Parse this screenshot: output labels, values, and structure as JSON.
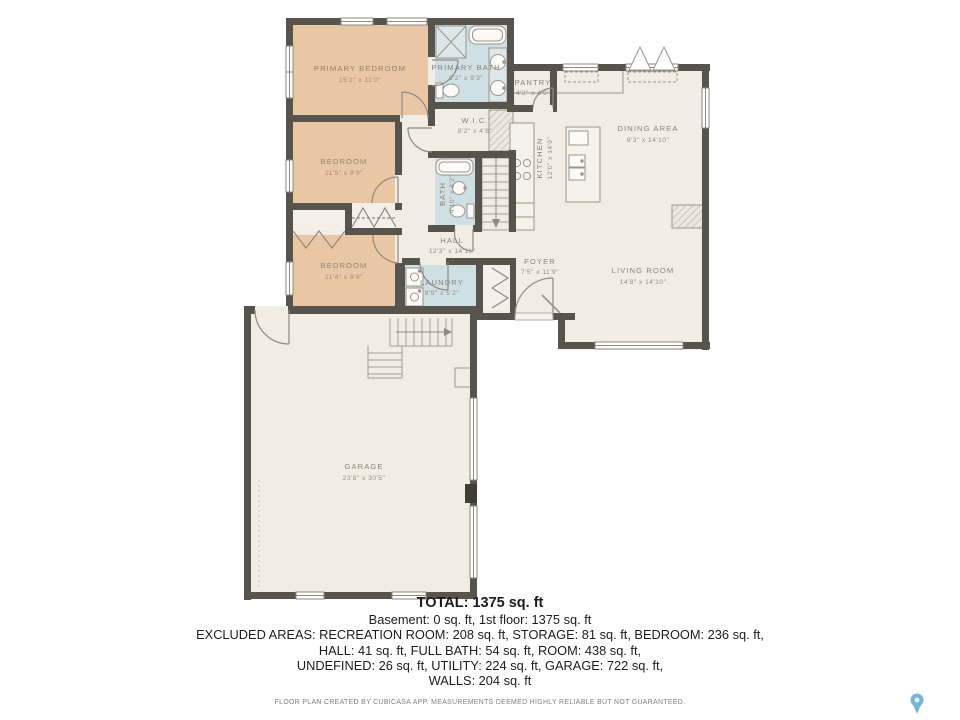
{
  "rooms": [
    {
      "id": "primary-bedroom",
      "name": "PRIMARY BEDROOM",
      "dims": "15'2\" x 11'0\""
    },
    {
      "id": "primary-bath",
      "name": "PRIMARY BATH",
      "dims": "8'2\" x 9'3\""
    },
    {
      "id": "wic",
      "name": "W.I.C.",
      "dims": "8'2\" x 4'8\""
    },
    {
      "id": "pantry",
      "name": "PANTRY",
      "dims": "4'2\" x 4'0\""
    },
    {
      "id": "kitchen",
      "name": "KITCHEN",
      "dims": "12'0\" x 14'9\""
    },
    {
      "id": "dining-area",
      "name": "DINING AREA",
      "dims": "9'3\" x 14'10\""
    },
    {
      "id": "bedroom-2",
      "name": "BEDROOM",
      "dims": "11'5\" x 8'9\""
    },
    {
      "id": "bath",
      "name": "BATH",
      "dims": "4'10\" x 8'2\""
    },
    {
      "id": "hall",
      "name": "HALL",
      "dims": "12'3\" x 14'11\""
    },
    {
      "id": "bedroom-3",
      "name": "BEDROOM",
      "dims": "11'4\" x 8'8\""
    },
    {
      "id": "laundry",
      "name": "LAUNDRY",
      "dims": "8'5\" x 5'2\""
    },
    {
      "id": "foyer",
      "name": "FOYER",
      "dims": "7'5\" x 11'9\""
    },
    {
      "id": "living-room",
      "name": "LIVING ROOM",
      "dims": "14'8\" x 14'10\""
    },
    {
      "id": "garage",
      "name": "GARAGE",
      "dims": "23'8\" x 30'5\""
    }
  ],
  "summary": {
    "total": "TOTAL: 1375 sq. ft",
    "line1": "Basement: 0 sq. ft, 1st floor: 1375 sq. ft",
    "line2": "EXCLUDED AREAS: RECREATION ROOM: 208 sq. ft, STORAGE: 81 sq. ft, BEDROOM: 236 sq. ft,",
    "line3": "HALL: 41 sq. ft, FULL BATH: 54 sq. ft, ROOM: 438 sq. ft,",
    "line4": "UNDEFINED: 26 sq. ft, UTILITY: 224 sq. ft, GARAGE: 722 sq. ft,",
    "line5": "WALLS: 204 sq. ft"
  },
  "footer_note": "FLOOR PLAN CREATED BY CUBICASA APP. MEASUREMENTS DEEMED HIGHLY RELIABLE BUT NOT GUARANTEED.",
  "colors": {
    "floor": "#f1ede5",
    "bedroom_fill": "#eac7a4",
    "wet_room_fill": "#cfe0e4",
    "wall": "#57534d",
    "label_text": "#8e8173",
    "pin_blue": "#74b7dd"
  }
}
